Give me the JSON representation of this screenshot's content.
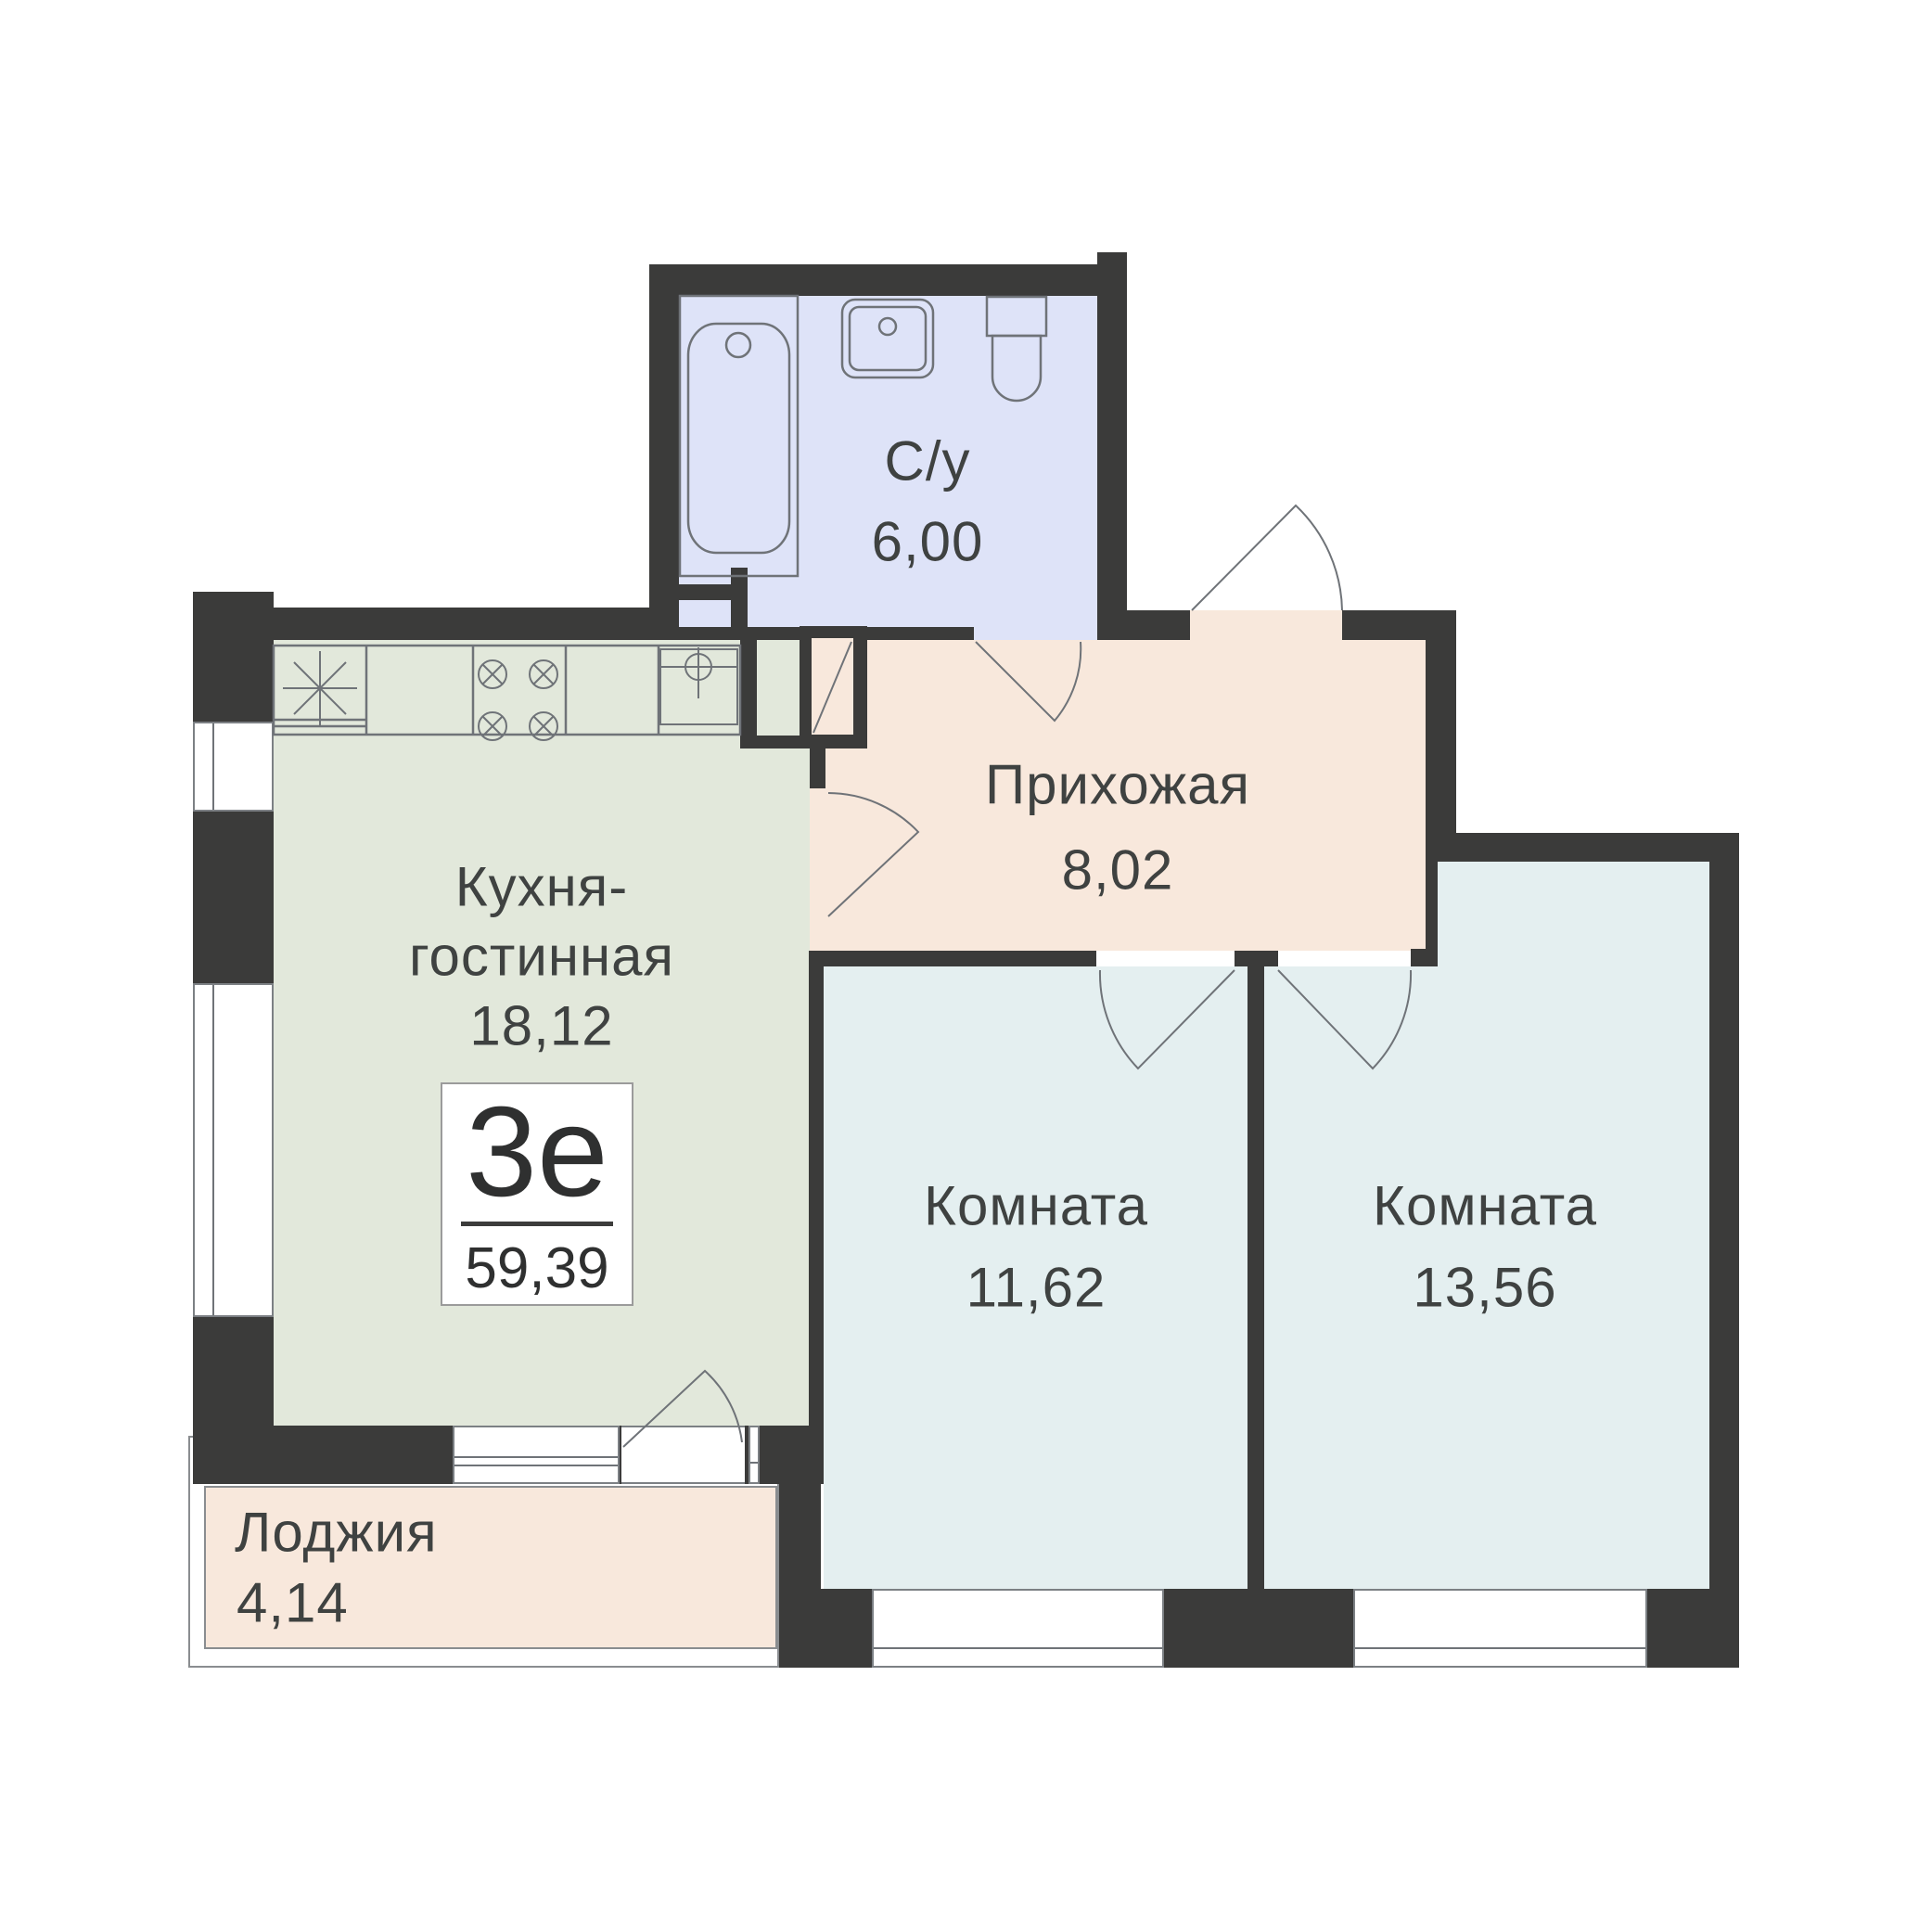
{
  "badge": {
    "type": "3е",
    "total_area": "59,39"
  },
  "rooms": [
    {
      "key": "bathroom",
      "label": "С/у",
      "area": "6,00"
    },
    {
      "key": "hallway",
      "label": "Прихожая",
      "area": "8,02"
    },
    {
      "key": "kitchen_living",
      "label_line1": "Кухня-",
      "label_line2": "гостинная",
      "area": "18,12"
    },
    {
      "key": "room1",
      "label": "Комната",
      "area": "11,62"
    },
    {
      "key": "room2",
      "label": "Комната",
      "area": "13,56"
    },
    {
      "key": "loggia",
      "label": "Лоджия",
      "area": "4,14"
    }
  ],
  "fixtures": [
    "bathtub",
    "bathroom-sink",
    "toilet",
    "fridge",
    "stove-burners",
    "kitchen-sink"
  ],
  "colors": {
    "wall": "#3b3b3a",
    "bathroom_floor": "#dee3f8",
    "kitchen_floor": "#e2e8db",
    "hallway_floor": "#f8e8dc",
    "room_floor": "#e4eff0",
    "loggia_floor": "#f8e8dc",
    "outline": "#6f7378",
    "text": "#3f4241"
  }
}
